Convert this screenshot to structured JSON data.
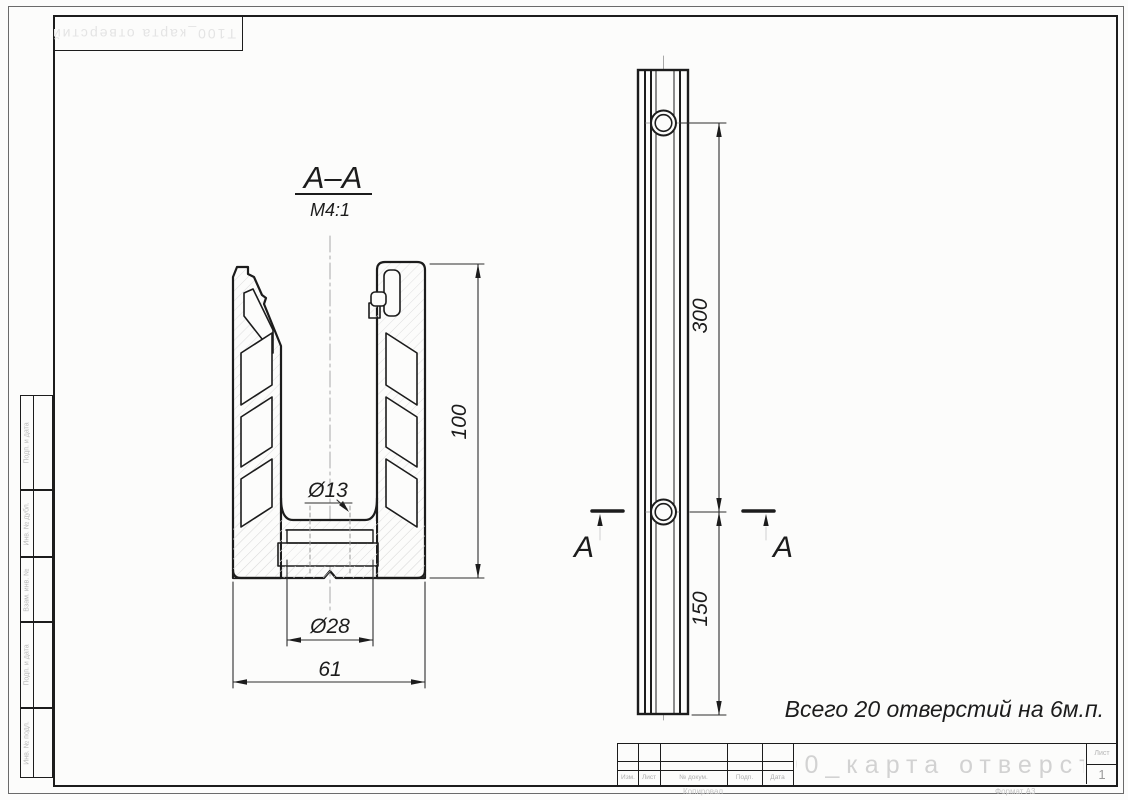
{
  "drawing": {
    "section_title": "А–А",
    "section_scale": "М4:1",
    "cut_label_left": "А",
    "cut_label_right": "А",
    "note": "Всего 20 отверстий на 6м.п.",
    "dims": {
      "height": "100",
      "hole_small": "Ø13",
      "hole_counterbore": "Ø28",
      "width": "61",
      "hole_spacing": "300",
      "end_offset": "150"
    }
  },
  "title_block": {
    "designation": "Т100_карта отверстий",
    "row_labels": [
      "Изм.",
      "Лист",
      "№ докум.",
      "Подп.",
      "Дата"
    ],
    "sheet_label": "Лист",
    "sheet_number": "1",
    "copy_label": "Копировал",
    "format_label": "Формат А3"
  },
  "margin": {
    "labels": [
      "Подп. и дата",
      "Инв. № дубл.",
      "Взам. инв. №",
      "Подп. и дата",
      "Инв. № подл."
    ]
  },
  "corner_stamp": "Т100_карта отверстий",
  "colors": {
    "line": "#1c1c1c",
    "faint": "#c9c9c9",
    "hatch": "#dedede"
  }
}
